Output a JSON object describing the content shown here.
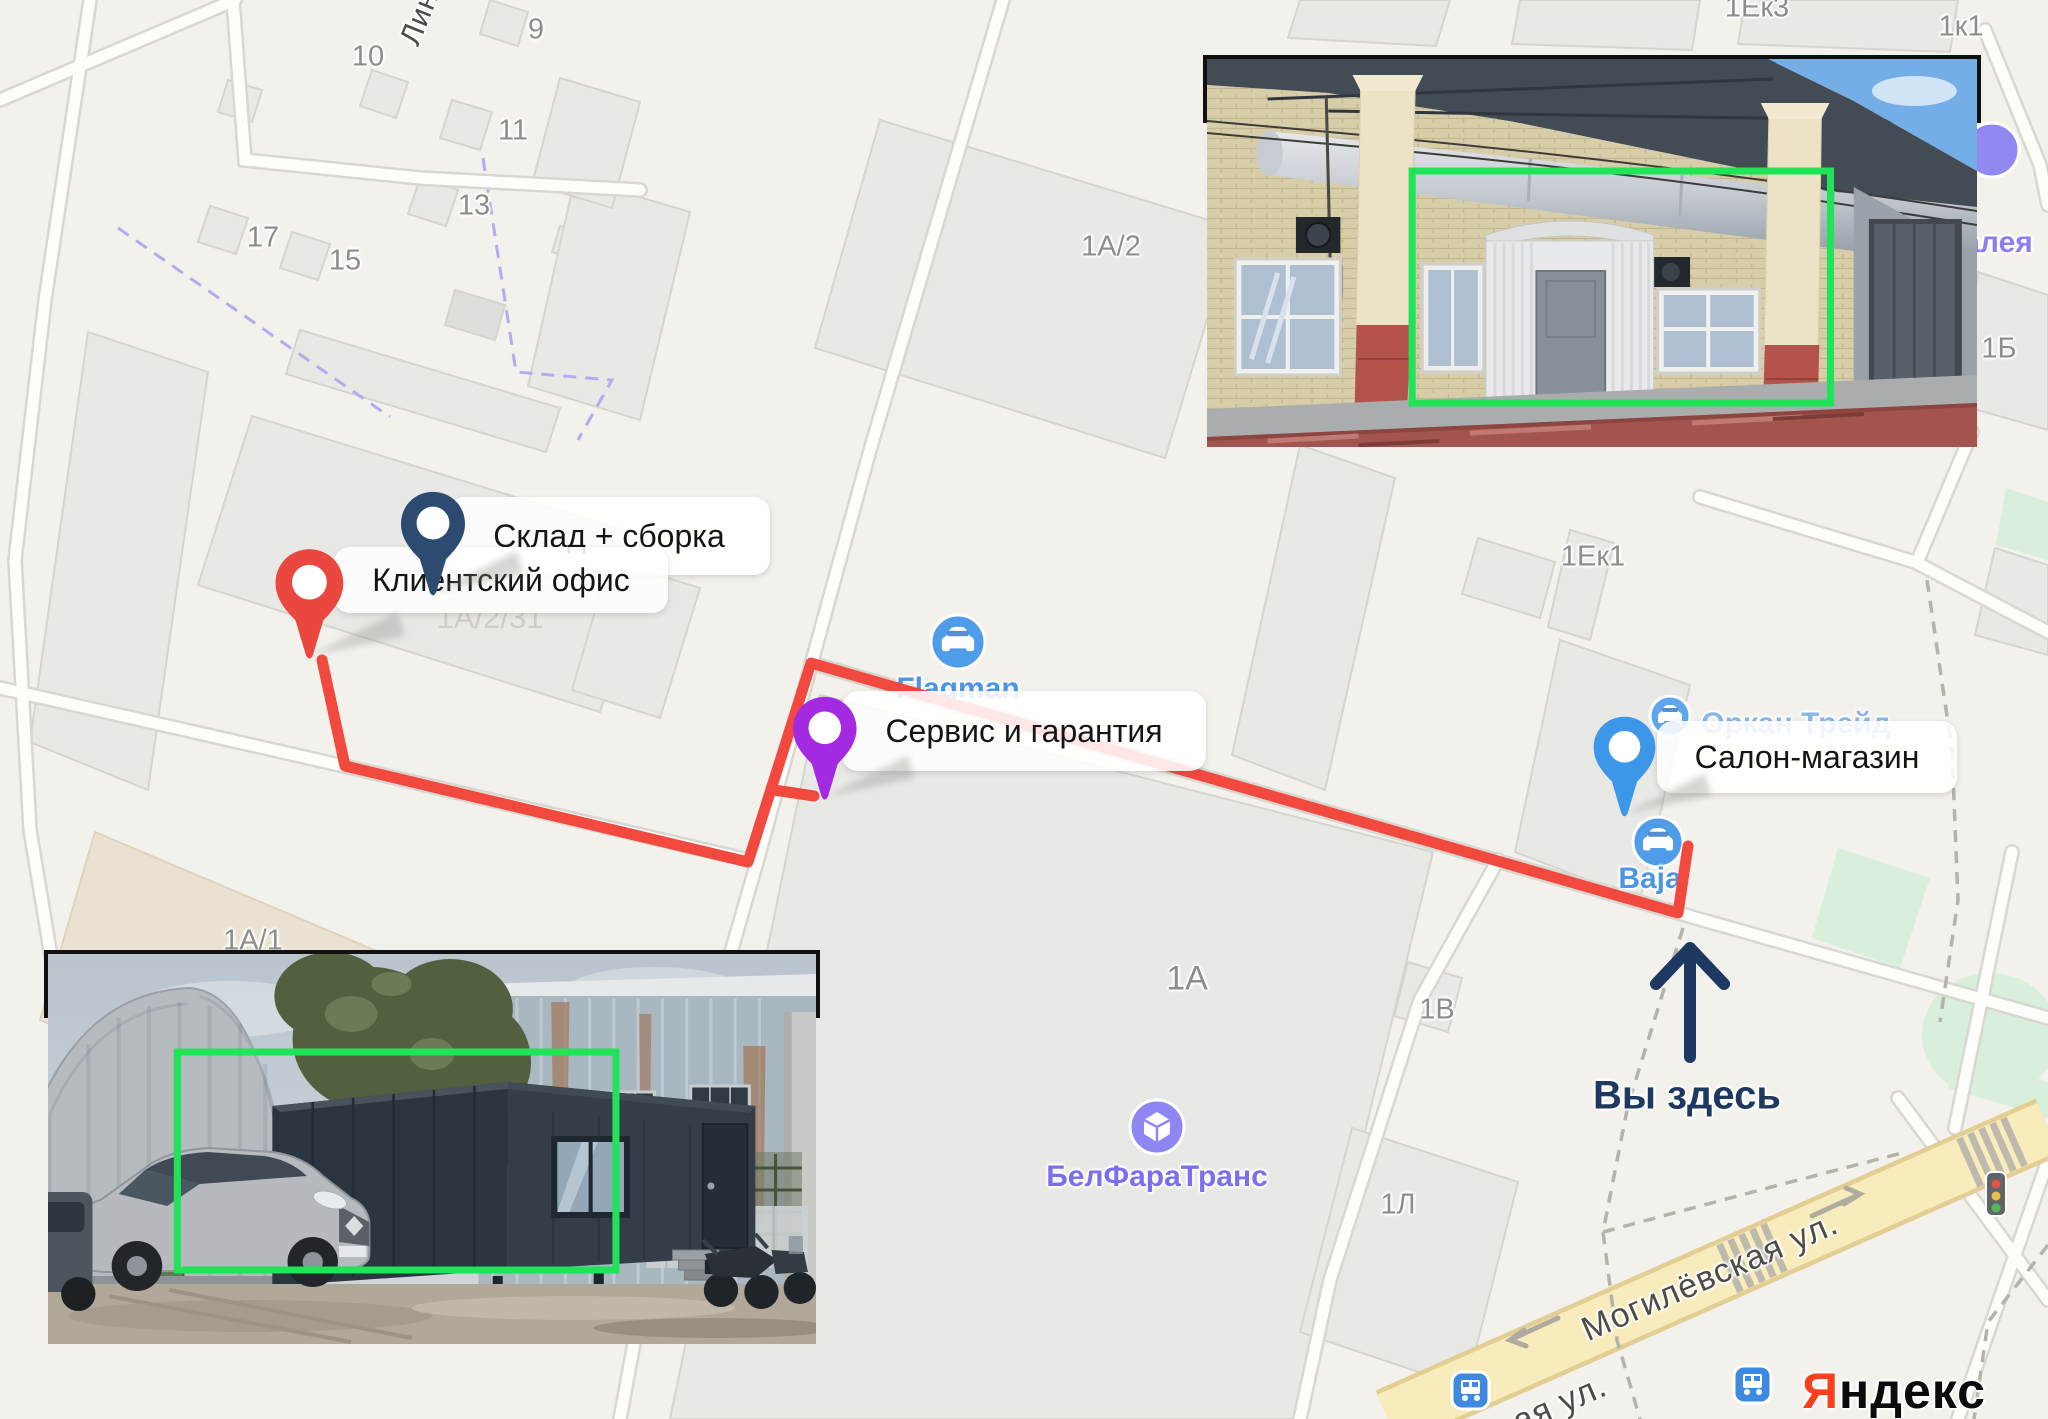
{
  "map": {
    "building_labels": [
      {
        "text": "10"
      },
      {
        "text": "9"
      },
      {
        "text": "11"
      },
      {
        "text": "13"
      },
      {
        "text": "17"
      },
      {
        "text": "15"
      },
      {
        "text": "1А/2"
      },
      {
        "text": "1Ек3"
      },
      {
        "text": "1к1"
      },
      {
        "text": "1Б"
      },
      {
        "text": "1Ек1"
      },
      {
        "text": "1А"
      },
      {
        "text": "1В"
      },
      {
        "text": "1Л"
      },
      {
        "text": "1А/1"
      },
      {
        "text": "1А/2/31"
      }
    ],
    "street_labels": {
      "rotated_top_left": "Лин",
      "main_street": "Могилёвская ул.",
      "street_fragment": "ая ул."
    },
    "colors": {
      "background": "#f2f1ec",
      "building": "#e8e8e5",
      "road": "#fdfdfa",
      "main_road": "#f8ecbc",
      "green_area": "#d9eedb",
      "boundary": "#b3abef"
    }
  },
  "markers": [
    {
      "label": "Склад + сборка",
      "color": "#2d4b71"
    },
    {
      "label": "Клиентский офис",
      "color": "#ea4741"
    },
    {
      "label": "Сервис и гарантия",
      "color": "#a32ae0"
    },
    {
      "label": "Салон-магазин",
      "color": "#3d97e8"
    }
  ],
  "pois": [
    {
      "name": "Flagman",
      "color": "#4d95e6"
    },
    {
      "name": "Baja",
      "color": "#4d95e6"
    },
    {
      "name": "Оркан Трейд",
      "color": "#8ab6e8"
    },
    {
      "name": "БелФараТранс",
      "color": "#7b6ff0"
    },
    {
      "name": "алея",
      "color": "#8b7ff0"
    }
  ],
  "annotations": {
    "you_are_here": "Вы здесь",
    "route_color": "#f2493f",
    "highlight_color": "#21e357"
  },
  "insets": [
    {
      "caption": "Сервис и гарантия"
    },
    {
      "caption": "Клиентский офис"
    }
  ],
  "logo": {
    "ya": "Я",
    "rest": "ндекс"
  }
}
